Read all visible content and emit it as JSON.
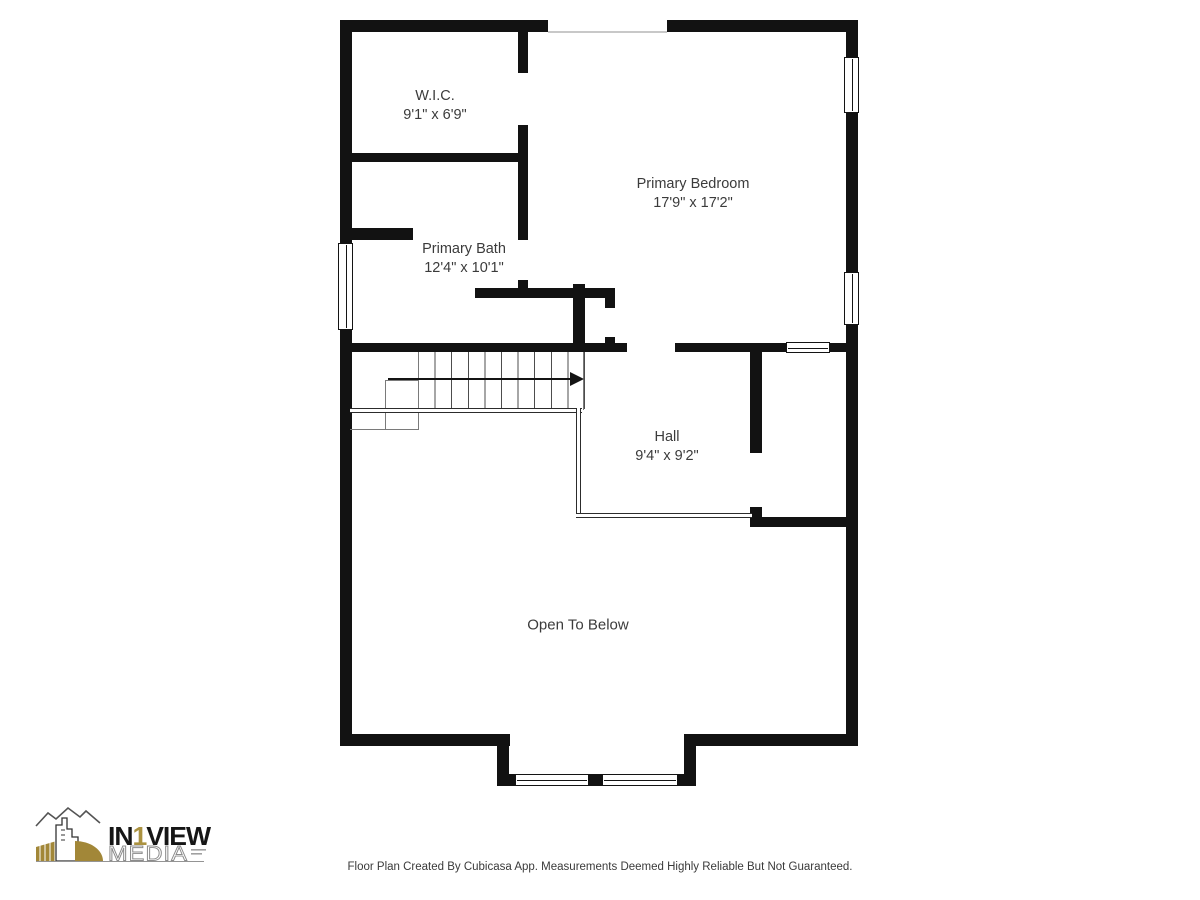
{
  "floorplan": {
    "rooms": [
      {
        "name": "W.I.C.",
        "dims": "9'1\" x 6'9\""
      },
      {
        "name": "Primary Bedroom",
        "dims": "17'9\" x 17'2\""
      },
      {
        "name": "Primary Bath",
        "dims": "12'4\" x 10'1\""
      },
      {
        "name": "Hall",
        "dims": "9'4\" x 9'2\""
      },
      {
        "name": "Open To Below",
        "dims": ""
      }
    ],
    "symbols": [
      "window",
      "stairs",
      "stairs-direction-arrow"
    ]
  },
  "logo": {
    "prefix": "IN",
    "one": "1",
    "suffix": "VIEW",
    "media": "MEDIA"
  },
  "footer": {
    "disclaimer": "Floor Plan Created By Cubicasa App. Measurements Deemed Highly Reliable But Not Guaranteed."
  },
  "colors": {
    "wall": "#121212",
    "label_text": "#3b3b3b",
    "logo_gold": "#a28738",
    "logo_media_gray": "#8b8b8b"
  }
}
